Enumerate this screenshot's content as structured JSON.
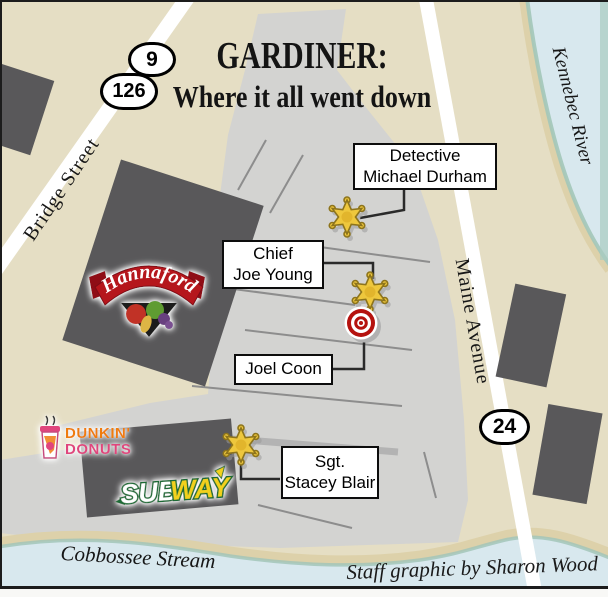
{
  "title": {
    "line1": "GARDINER:",
    "line2": "Where it all went down"
  },
  "streets": {
    "bridge": "Bridge Street",
    "maine": "Maine Avenue"
  },
  "waterways": {
    "kennebec": "Kennebec River",
    "cobbossee": "Cobbossee Stream"
  },
  "route_shields": [
    {
      "number": "9"
    },
    {
      "number": "126"
    },
    {
      "number": "24"
    }
  ],
  "callouts": [
    {
      "lines": [
        "Detective",
        "Michael Durham"
      ],
      "marker": "sheriff-star-badge-icon"
    },
    {
      "lines": [
        "Chief",
        "Joe Young"
      ],
      "marker": "sheriff-star-badge-icon"
    },
    {
      "lines": [
        "Joel Coon"
      ],
      "marker": "bullseye-target-icon"
    },
    {
      "lines": [
        "Sgt.",
        "Stacey Blair"
      ],
      "marker": "sheriff-star-badge-icon"
    }
  ],
  "logos": {
    "hannaford": {
      "text": "Hannaford"
    },
    "dunkin": {
      "line1": "DUNKIN'",
      "line2": "DONUTS",
      "icon": "coffee-cup-icon"
    },
    "subway": {
      "part1": "SUB",
      "part2": "WAY"
    }
  },
  "credit": "Staff graphic by Sharon Wood",
  "colors": {
    "land": "#e5dec4",
    "parking_lot": "#d3d3d1",
    "building": "#59585a",
    "water": "#d8e8ee",
    "shore_sand": "#ddd1aa",
    "shore_teal": "#a3c6b8",
    "star_gold": "#eec73d",
    "target_red": "#b5120e",
    "hannaford_red": "#b5121b",
    "dunkin_orange": "#ef7b10",
    "dunkin_pink": "#e0457d",
    "subway_green": "#1c6b34",
    "subway_yellow": "#f2d11e"
  }
}
